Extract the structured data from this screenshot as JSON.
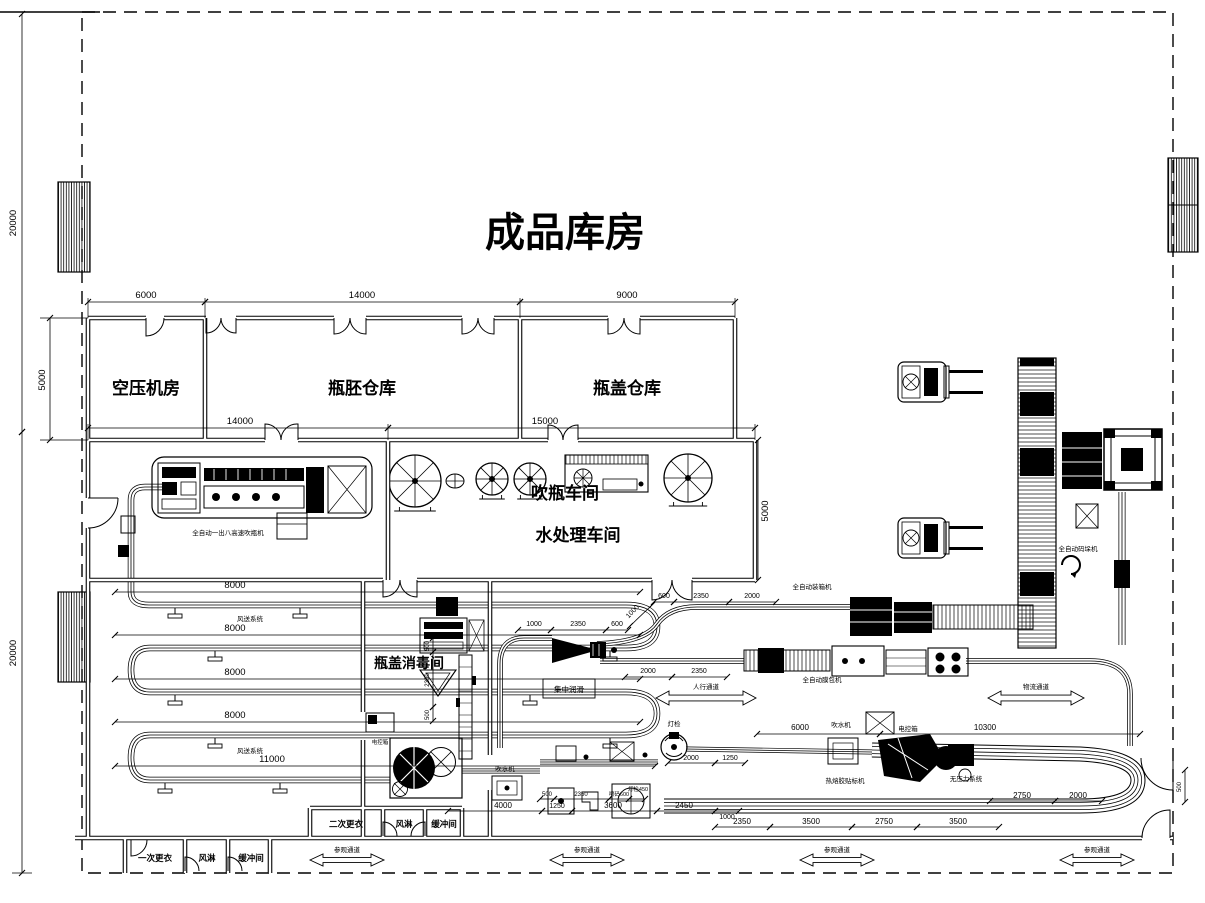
{
  "title": "成品库房",
  "rooms": {
    "air_compressor": "空压机房",
    "preform_warehouse": "瓶胚仓库",
    "cap_warehouse": "瓶盖仓库",
    "blow_workshop": "吹瓶车间",
    "water_treatment": "水处理车间",
    "cap_sterilization": "瓶盖消毒间",
    "second_changing": "二次更衣",
    "air_shower": "风淋",
    "buffer_room": "缓冲间",
    "first_changing": "一次更衣"
  },
  "equipment": {
    "blow_machine": "全自动一出八高速吹瓶机",
    "air_conveying_system": "风送系统",
    "central_lubrication": "集中润滑",
    "water_remover": "吹水机",
    "light_inspection": "灯检",
    "control_box": "电控箱",
    "case_packer": "全自动装箱机",
    "film_wrapper": "全自动膜包机",
    "labeling_machine": "热熔胶贴标机",
    "no_pressure_system": "无压力系统",
    "palletizer": "全自动码垛机"
  },
  "corridors": {
    "pedestrian": "人行通道",
    "logistics": "物流通道",
    "visitor": "参观通道"
  },
  "dimensions": {
    "d20000": "20000",
    "d5000": "5000",
    "d6000": "6000",
    "d14000": "14000",
    "d9000": "9000",
    "d15000": "15000",
    "d8000": "8000",
    "d11000": "11000",
    "d1000": "1000",
    "d2350": "2350",
    "d600": "600",
    "d2000": "2000",
    "d500": "500",
    "d1250": "1250",
    "d10300": "10300",
    "d4000": "4000",
    "d3600": "3600",
    "d2450": "2450",
    "d3500": "3500",
    "d2750": "2750",
    "d600_coder": "喷码600",
    "d450_lamp": "灯检450"
  }
}
